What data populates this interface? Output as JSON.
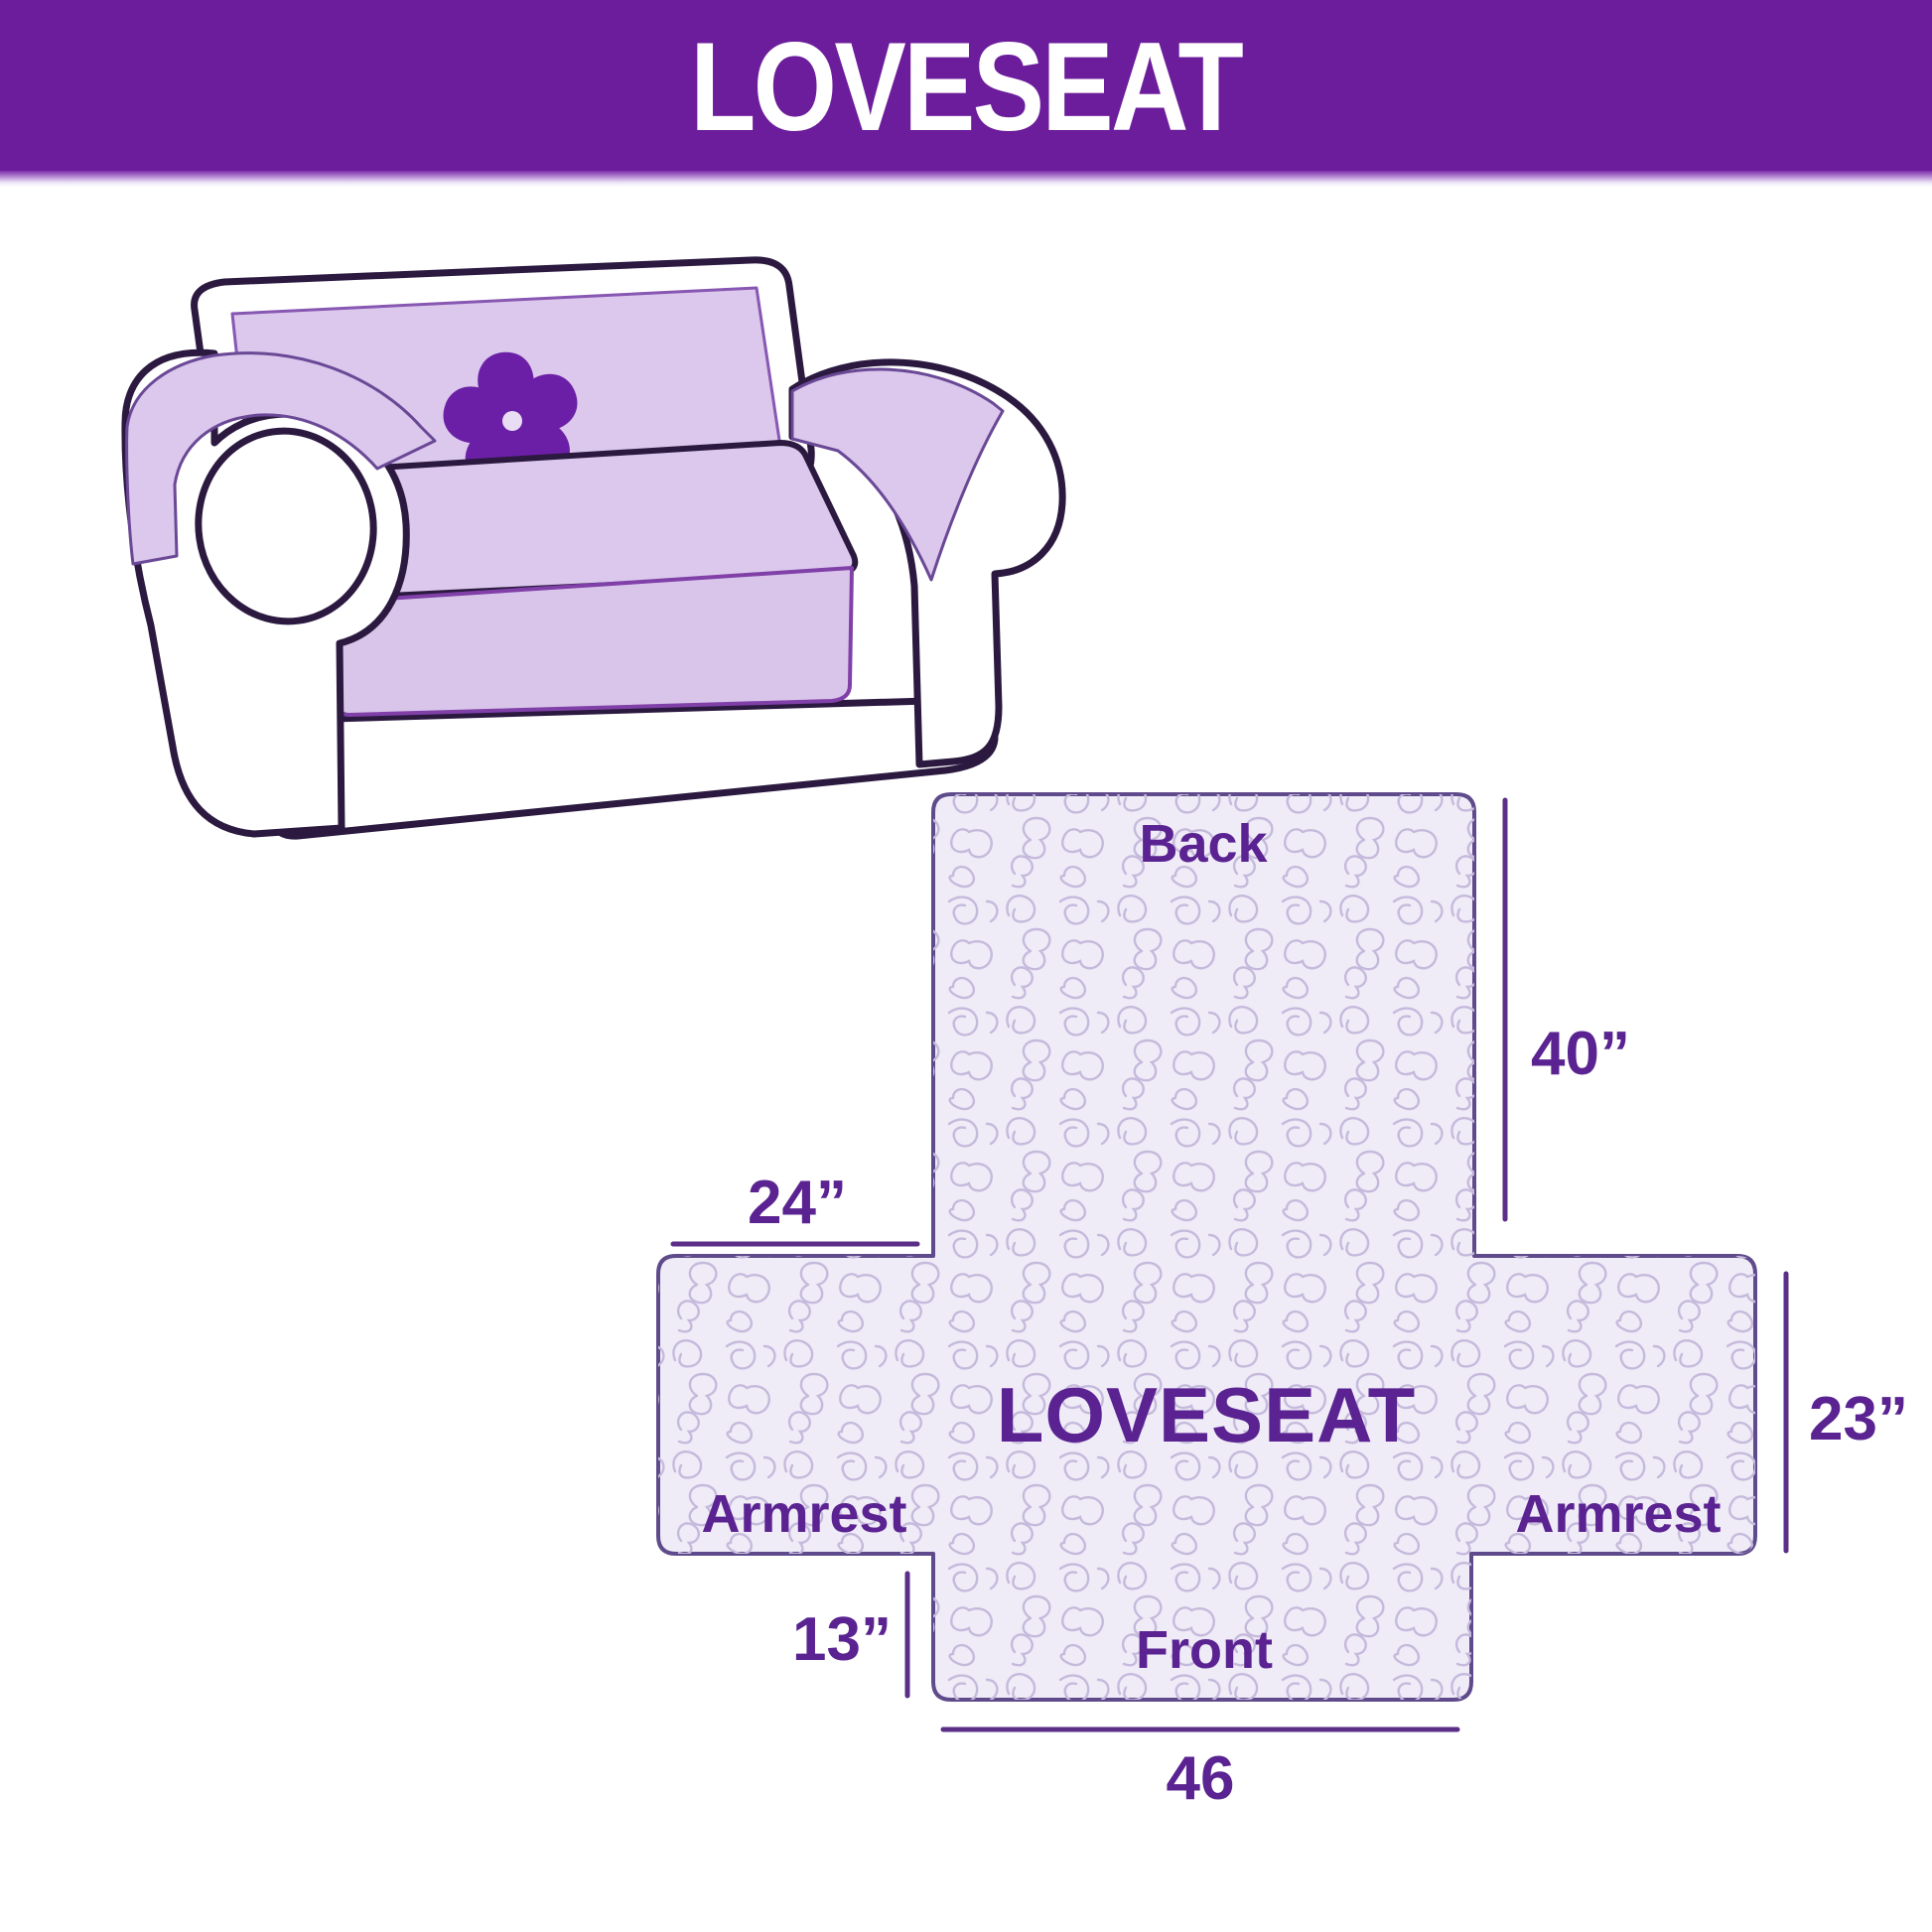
{
  "header": {
    "title": "LOVESEAT"
  },
  "sofa": {
    "description": "loveseat-sofa-line-art-with-lavender-cover",
    "logo_icon": "pinwheel-flower-icon"
  },
  "diagram": {
    "title": "LOVESEAT",
    "back_label": "Back",
    "front_label": "Front",
    "armrest_left_label": "Armrest",
    "armrest_right_label": "Armrest",
    "dim_back_height": "40”",
    "dim_armrest_width": "24”",
    "dim_armrest_height": "23”",
    "dim_front_height": "13”",
    "dim_front_width": "46"
  },
  "colors": {
    "header_bg": "#6C1D9B",
    "header_text": "#FFFFFF",
    "label_text": "#5A2391",
    "dimension_line": "#5B2E87",
    "cover_lavender": "#DBC8EC",
    "sofa_outline": "#2B1940",
    "logo_purple": "#6B1FA6",
    "cross_fill": "#EFEBF7",
    "cross_pattern": "#C6BADC",
    "cross_outline": "#5F4B8B"
  }
}
